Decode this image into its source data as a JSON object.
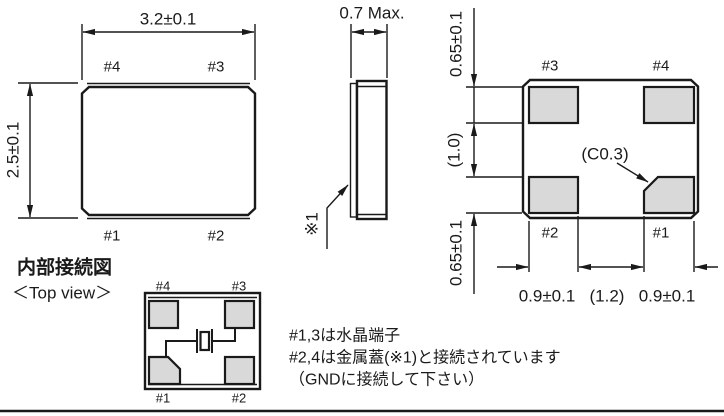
{
  "figure_type": "package-dimension-drawing",
  "colors": {
    "line": "#1a1a1a",
    "pad_fill": "#d9d9d9",
    "background": "#ffffff"
  },
  "top_view": {
    "dim_width": "3.2±0.1",
    "dim_height": "2.5±0.1",
    "pad_labels": {
      "top_left": "#4",
      "top_right": "#3",
      "bottom_left": "#1",
      "bottom_right": "#2"
    }
  },
  "side_view": {
    "dim_thickness": "0.7 Max.",
    "lid_ref": "※1"
  },
  "bottom_view": {
    "dim_pad_height_top": "0.65±0.1",
    "dim_pad_gap": "(1.0)",
    "dim_pad_height_bottom": "0.65±0.1",
    "dim_pad_width_left": "0.9±0.1",
    "dim_pad_pitch": "(1.2)",
    "dim_pad_width_right": "0.9±0.1",
    "dim_chamfer": "(C0.3)",
    "pad_labels": {
      "top_left": "#3",
      "top_right": "#4",
      "bottom_left": "#2",
      "bottom_right": "#1"
    }
  },
  "internal_diagram": {
    "title": "内部接続図",
    "subtitle": "＜Top view＞",
    "pad_labels": {
      "top_left": "#4",
      "top_right": "#3",
      "bottom_left": "#1",
      "bottom_right": "#2"
    }
  },
  "notes": {
    "line1": "#1,3は水晶端子",
    "line2": "#2,4は金属蓋(※1)と接続されています",
    "line3": "（GNDに接続して下さい）"
  }
}
